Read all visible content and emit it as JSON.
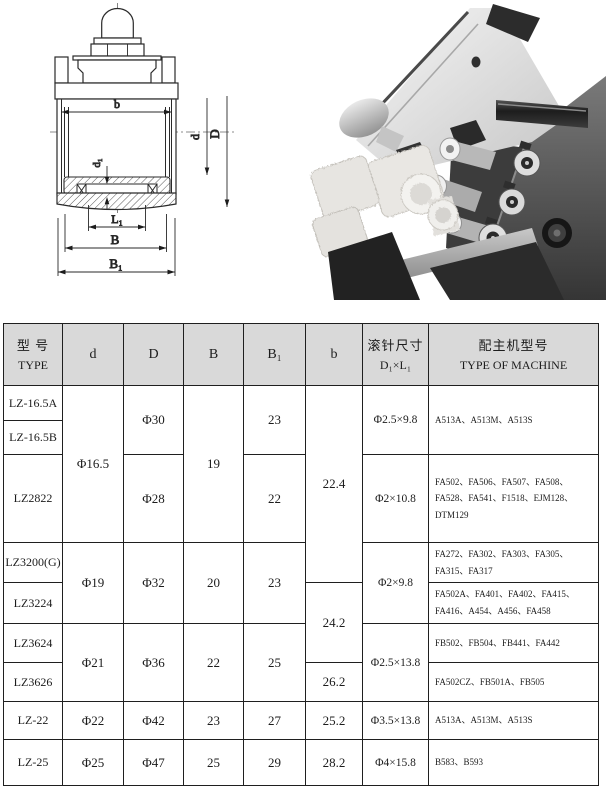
{
  "colors": {
    "table_header_bg": "#d9d9d9",
    "line": "#1f1f1f",
    "paper": "#ffffff"
  },
  "drawing": {
    "labels": {
      "b": "b",
      "d": "d",
      "D": "D",
      "d1": "d₁",
      "L1": "L₁",
      "B": "B",
      "B1": "B₁"
    }
  },
  "table": {
    "header": {
      "type_cn": "型 号",
      "type_en": "TYPE",
      "d": "d",
      "D": "D",
      "B": "B",
      "B1": "B₁",
      "b": "b",
      "pin_cn": "滚针尺寸",
      "pin_en": "D₁×L₁",
      "machine_cn": "配主机型号",
      "machine_en": "TYPE OF MACHINE"
    },
    "rows": [
      {
        "type": "LZ-16.5A",
        "d": "Φ16.5",
        "D": "Φ30",
        "B": "19",
        "B1": "23",
        "b": "22.4",
        "pin": "Φ2.5×9.8",
        "machine": "A513A、A513M、A513S"
      },
      {
        "type": "LZ-16.5B"
      },
      {
        "type": "LZ2822",
        "D": "Φ28",
        "B1": "22",
        "pin": "Φ2×10.8",
        "machine": "FA502、FA506、FA507、FA508、FA528、FA541、F1518、EJM128、DTM129"
      },
      {
        "type": "LZ3200(G)",
        "d": "Φ19",
        "D": "Φ32",
        "B": "20",
        "B1": "23",
        "pin": "Φ2×9.8",
        "machine": "FA272、FA302、FA303、FA305、FA315、FA317"
      },
      {
        "type": "LZ3224",
        "b": "24.2",
        "machine": "FA502A、FA401、FA402、FA415、FA416、A454、A456、FA458"
      },
      {
        "type": "LZ3624",
        "d": "Φ21",
        "D": "Φ36",
        "B": "22",
        "B1": "25",
        "pin": "Φ2.5×13.8",
        "machine": "FB502、FB504、FB441、FA442"
      },
      {
        "type": "LZ3626",
        "b": "26.2",
        "machine": "FA502CZ、FB501A、FB505"
      },
      {
        "type": "LZ-22",
        "d": "Φ22",
        "D": "Φ42",
        "B": "23",
        "B1": "27",
        "b": "25.2",
        "pin": "Φ3.5×13.8",
        "machine": "A513A、A513M、A513S"
      },
      {
        "type": "LZ-25",
        "d": "Φ25",
        "D": "Φ47",
        "B": "25",
        "B1": "29",
        "b": "28.2",
        "pin": "Φ4×15.8",
        "machine": "B583、B593"
      }
    ]
  }
}
